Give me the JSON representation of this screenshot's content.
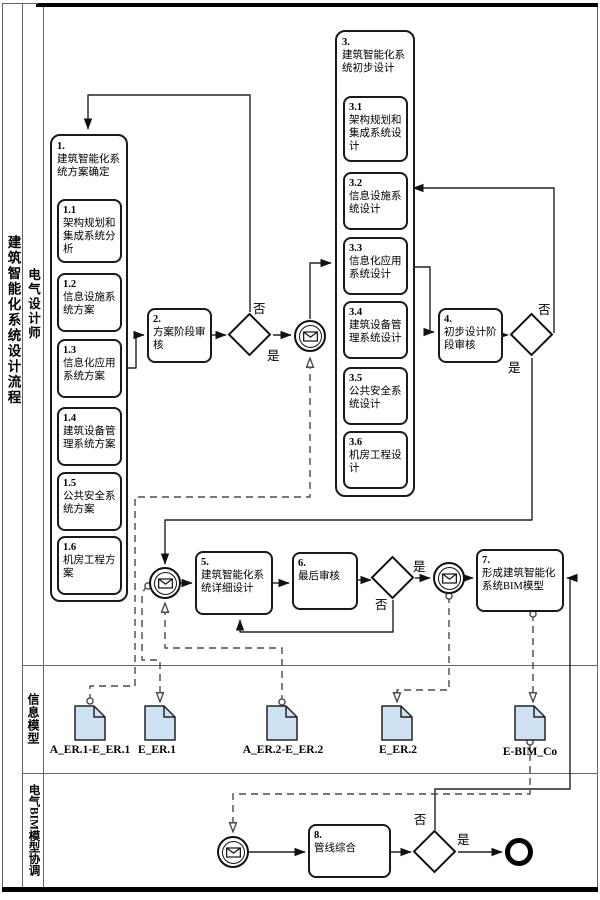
{
  "pool": {
    "title": "建筑智能化系统设计流程"
  },
  "lanes": [
    {
      "label": "电气设计师"
    },
    {
      "label": "信息模型"
    },
    {
      "label": "电气BIM模型协调"
    }
  ],
  "groups": [
    {
      "num": "1.",
      "label": "建筑智能化系统方案确定",
      "subs": [
        {
          "num": "1.1",
          "label": "架构规划和集成系统分析"
        },
        {
          "num": "1.2",
          "label": "信息设施系统方案"
        },
        {
          "num": "1.3",
          "label": "信息化应用系统方案"
        },
        {
          "num": "1.4",
          "label": "建筑设备管理系统方案"
        },
        {
          "num": "1.5",
          "label": "公共安全系统方案"
        },
        {
          "num": "1.6",
          "label": "机房工程方案"
        }
      ]
    },
    {
      "num": "3.",
      "label": "建筑智能化系统初步设计",
      "subs": [
        {
          "num": "3.1",
          "label": "架构规划和集成系统设计"
        },
        {
          "num": "3.2",
          "label": "信息设施系统设计"
        },
        {
          "num": "3.3",
          "label": "信息化应用系统设计"
        },
        {
          "num": "3.4",
          "label": "建筑设备管理系统设计"
        },
        {
          "num": "3.5",
          "label": "公共安全系统设计"
        },
        {
          "num": "3.6",
          "label": "机房工程设计"
        }
      ]
    }
  ],
  "tasks": [
    {
      "num": "2.",
      "label": "方案阶段审核"
    },
    {
      "num": "4.",
      "label": "初步设计阶段审核"
    },
    {
      "num": "5.",
      "label": "建筑智能化系统详细设计"
    },
    {
      "num": "6.",
      "label": "最后审核"
    },
    {
      "num": "7.",
      "label": "形成建筑智能化系统BIM模型"
    },
    {
      "num": "8.",
      "label": "管线综合"
    }
  ],
  "labels": {
    "yes": "是",
    "no": "否"
  },
  "documents": [
    {
      "label": "A_ER.1-E_ER.1"
    },
    {
      "label": "E_ER.1"
    },
    {
      "label": "A_ER.2-E_ER.2"
    },
    {
      "label": "E_ER.2"
    },
    {
      "label": "E-BIM_Co"
    }
  ],
  "colors": {
    "document_fill": "#cfe2f3",
    "stroke": "#1a1a1a",
    "dashed": "#4a4a4a"
  }
}
